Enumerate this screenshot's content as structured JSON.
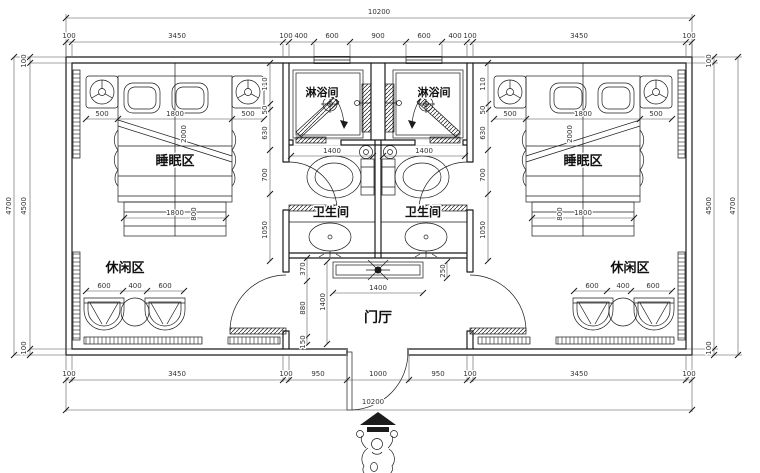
{
  "labels": {
    "shower": "淋浴间",
    "toilet": "卫生间",
    "sleeping": "睡眠区",
    "leisure": "休闲区",
    "hall": "门厅"
  },
  "dims": {
    "total_width": "10200",
    "top_row": [
      "100",
      "3450",
      "100",
      "400",
      "600",
      "900",
      "600",
      "400",
      "100",
      "3450",
      "100"
    ],
    "bottom_row": [
      "100",
      "3450",
      "100",
      "950",
      "1000",
      "950",
      "100",
      "3450",
      "100"
    ],
    "side": {
      "outer": "4700",
      "top": "100",
      "inner": "4500",
      "bottom": "100"
    },
    "bed": {
      "side": "500",
      "width": "1800",
      "length": "2000",
      "foot_width": "1800",
      "foot_depth": "800"
    },
    "leisure": {
      "side": "600",
      "center": "400"
    },
    "bath_width": "1400",
    "wall_chain": [
      "110",
      "50",
      "630",
      "700",
      "1050"
    ],
    "hall": {
      "chain": [
        "370",
        "880",
        "150"
      ],
      "height": "1400",
      "counter_width": "1400",
      "counter_depth": "250"
    }
  },
  "colors": {
    "line": "#1b1b1b",
    "dim": "#3a3a3a",
    "background": "#ffffff"
  }
}
